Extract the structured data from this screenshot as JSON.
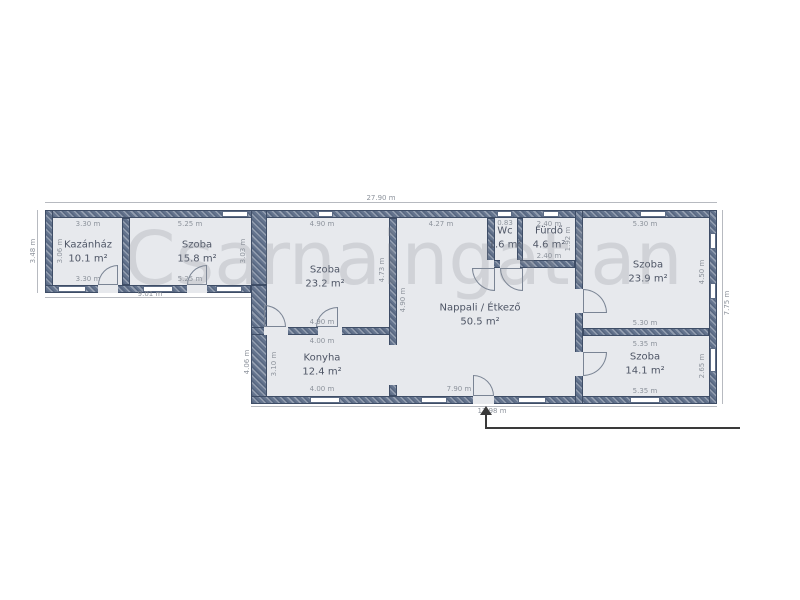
{
  "watermark": {
    "text": "Csarnaingatlan"
  },
  "colors": {
    "wall": "#64748e",
    "wall_border": "#3e4d66",
    "room_fill": "#e7e9ed",
    "dim_text": "#8d939c",
    "label_text": "#4e5565",
    "watermark": "#9a9fa6"
  },
  "plan": {
    "rooms": [
      {
        "name": "Kazánház",
        "area": "10.1 m²",
        "cx": 88,
        "cy": 252
      },
      {
        "name": "Szoba",
        "area": "15.8 m²",
        "cx": 197,
        "cy": 252
      },
      {
        "name": "Szoba",
        "area": "23.2 m²",
        "cx": 325,
        "cy": 277
      },
      {
        "name": "Konyha",
        "area": "12.4 m²",
        "cx": 322,
        "cy": 365
      },
      {
        "name": "Nappali / Étkező",
        "area": "50.5 m²",
        "cx": 480,
        "cy": 315
      },
      {
        "name": "Wc",
        "area": "1.6 m²",
        "cx": 505,
        "cy": 238
      },
      {
        "name": "Fürdő",
        "area": "4.6 m²",
        "cx": 549,
        "cy": 238
      },
      {
        "name": "Szoba",
        "area": "23.9 m²",
        "cx": 648,
        "cy": 272
      },
      {
        "name": "Szoba",
        "area": "14.1 m²",
        "cx": 645,
        "cy": 364
      }
    ],
    "room_fills": [
      {
        "x": 53,
        "y": 218,
        "w": 198,
        "h": 67
      },
      {
        "x": 267,
        "y": 218,
        "w": 442,
        "h": 178
      }
    ],
    "walls": [
      {
        "x": 45,
        "y": 210,
        "w": 672,
        "h": 8
      },
      {
        "x": 45,
        "y": 210,
        "w": 8,
        "h": 83
      },
      {
        "x": 45,
        "y": 285,
        "w": 206,
        "h": 8
      },
      {
        "x": 122,
        "y": 218,
        "w": 8,
        "h": 67
      },
      {
        "x": 251,
        "y": 210,
        "w": 16,
        "h": 75
      },
      {
        "x": 251,
        "y": 285,
        "w": 16,
        "h": 119
      },
      {
        "x": 251,
        "y": 396,
        "w": 466,
        "h": 8
      },
      {
        "x": 709,
        "y": 210,
        "w": 8,
        "h": 194
      },
      {
        "x": 251,
        "y": 327,
        "w": 146,
        "h": 8
      },
      {
        "x": 389,
        "y": 218,
        "w": 8,
        "h": 178
      },
      {
        "x": 575,
        "y": 210,
        "w": 8,
        "h": 194
      },
      {
        "x": 487,
        "y": 218,
        "w": 8,
        "h": 50
      },
      {
        "x": 517,
        "y": 218,
        "w": 6,
        "h": 50
      },
      {
        "x": 487,
        "y": 260,
        "w": 88,
        "h": 8
      },
      {
        "x": 583,
        "y": 328,
        "w": 126,
        "h": 8
      }
    ],
    "openings": [
      {
        "x": 98,
        "y": 285,
        "w": 20,
        "h": 8
      },
      {
        "x": 187,
        "y": 285,
        "w": 20,
        "h": 8
      },
      {
        "x": 264,
        "y": 327,
        "w": 24,
        "h": 8
      },
      {
        "x": 318,
        "y": 327,
        "w": 24,
        "h": 8
      },
      {
        "x": 389,
        "y": 345,
        "w": 8,
        "h": 40
      },
      {
        "x": 474,
        "y": 260,
        "w": 20,
        "h": 8
      },
      {
        "x": 500,
        "y": 260,
        "w": 20,
        "h": 8
      },
      {
        "x": 575,
        "y": 289,
        "w": 8,
        "h": 24
      },
      {
        "x": 575,
        "y": 352,
        "w": 8,
        "h": 24
      },
      {
        "x": 473,
        "y": 396,
        "w": 21,
        "h": 8
      }
    ],
    "windows": [
      {
        "x": 222,
        "y": 211,
        "w": 26,
        "h": 6
      },
      {
        "x": 318,
        "y": 211,
        "w": 15,
        "h": 6
      },
      {
        "x": 497,
        "y": 211,
        "w": 15,
        "h": 6
      },
      {
        "x": 543,
        "y": 211,
        "w": 16,
        "h": 6
      },
      {
        "x": 640,
        "y": 211,
        "w": 26,
        "h": 6
      },
      {
        "x": 58,
        "y": 286,
        "w": 28,
        "h": 6
      },
      {
        "x": 143,
        "y": 286,
        "w": 30,
        "h": 6
      },
      {
        "x": 216,
        "y": 286,
        "w": 26,
        "h": 6
      },
      {
        "x": 310,
        "y": 397,
        "w": 30,
        "h": 6
      },
      {
        "x": 421,
        "y": 397,
        "w": 26,
        "h": 6
      },
      {
        "x": 518,
        "y": 397,
        "w": 28,
        "h": 6
      },
      {
        "x": 630,
        "y": 397,
        "w": 30,
        "h": 6
      },
      {
        "x": 710,
        "y": 233,
        "w": 6,
        "h": 16
      },
      {
        "x": 710,
        "y": 283,
        "w": 6,
        "h": 16
      },
      {
        "x": 710,
        "y": 348,
        "w": 6,
        "h": 24
      }
    ],
    "doors": [
      {
        "x": 98,
        "y": 265,
        "w": 20,
        "h": 20,
        "corner": "tl"
      },
      {
        "x": 187,
        "y": 265,
        "w": 20,
        "h": 20,
        "corner": "tl"
      },
      {
        "x": 264,
        "y": 305,
        "w": 22,
        "h": 22,
        "corner": "tr"
      },
      {
        "x": 316,
        "y": 307,
        "w": 22,
        "h": 20,
        "corner": "tl"
      },
      {
        "x": 472,
        "y": 268,
        "w": 23,
        "h": 23,
        "corner": "bl"
      },
      {
        "x": 500,
        "y": 268,
        "w": 23,
        "h": 23,
        "corner": "bl"
      },
      {
        "x": 583,
        "y": 289,
        "w": 24,
        "h": 24,
        "corner": "tr"
      },
      {
        "x": 583,
        "y": 352,
        "w": 24,
        "h": 24,
        "corner": "br"
      },
      {
        "x": 473,
        "y": 375,
        "w": 21,
        "h": 21,
        "corner": "tr"
      }
    ],
    "dim_lines": [
      {
        "x": 45,
        "y": 202,
        "w": 672,
        "h": 1
      },
      {
        "x": 45,
        "y": 297,
        "w": 206,
        "h": 1
      },
      {
        "x": 251,
        "y": 406,
        "w": 466,
        "h": 1
      },
      {
        "x": 722,
        "y": 210,
        "w": 1,
        "h": 194
      },
      {
        "x": 37,
        "y": 210,
        "w": 1,
        "h": 83
      }
    ],
    "dim_labels": [
      {
        "text": "27.90 m",
        "x": 381,
        "y": 198,
        "v": false
      },
      {
        "text": "3.30 m",
        "x": 88,
        "y": 224,
        "v": false
      },
      {
        "text": "5.25 m",
        "x": 190,
        "y": 224,
        "v": false
      },
      {
        "text": "4.90 m",
        "x": 322,
        "y": 224,
        "v": false
      },
      {
        "text": "4.27 m",
        "x": 441,
        "y": 224,
        "v": false
      },
      {
        "text": "0.83",
        "x": 505,
        "y": 223,
        "v": false
      },
      {
        "text": "2.40 m",
        "x": 549,
        "y": 224,
        "v": false
      },
      {
        "text": "5.30 m",
        "x": 645,
        "y": 224,
        "v": false
      },
      {
        "text": "3.30 m",
        "x": 88,
        "y": 279,
        "v": false
      },
      {
        "text": "5.25 m",
        "x": 190,
        "y": 279,
        "v": false
      },
      {
        "text": "9.01 m",
        "x": 150,
        "y": 294,
        "v": false
      },
      {
        "text": "3.48 m",
        "x": 33,
        "y": 251,
        "v": true
      },
      {
        "text": "3.06 m",
        "x": 60,
        "y": 251,
        "v": true
      },
      {
        "text": "3.03 m",
        "x": 243,
        "y": 251,
        "v": true
      },
      {
        "text": "4.73 m",
        "x": 382,
        "y": 270,
        "v": true
      },
      {
        "text": "4.90 m",
        "x": 403,
        "y": 300,
        "v": true
      },
      {
        "text": "4.90 m",
        "x": 322,
        "y": 322,
        "v": false
      },
      {
        "text": "4.00 m",
        "x": 322,
        "y": 341,
        "v": false
      },
      {
        "text": "4.00 m",
        "x": 322,
        "y": 389,
        "v": false
      },
      {
        "text": "3.10 m",
        "x": 274,
        "y": 364,
        "v": true
      },
      {
        "text": "4.06 m",
        "x": 247,
        "y": 362,
        "v": true
      },
      {
        "text": "1.92 m",
        "x": 568,
        "y": 239,
        "v": true
      },
      {
        "text": "2.40 m",
        "x": 549,
        "y": 256,
        "v": false
      },
      {
        "text": "5.30 m",
        "x": 645,
        "y": 323,
        "v": false
      },
      {
        "text": "4.50 m",
        "x": 702,
        "y": 272,
        "v": true
      },
      {
        "text": "5.35 m",
        "x": 645,
        "y": 344,
        "v": false
      },
      {
        "text": "5.35 m",
        "x": 645,
        "y": 391,
        "v": false
      },
      {
        "text": "2.65 m",
        "x": 702,
        "y": 366,
        "v": true
      },
      {
        "text": "7.75 m",
        "x": 727,
        "y": 303,
        "v": true
      },
      {
        "text": "7.90 m",
        "x": 459,
        "y": 389,
        "v": false
      },
      {
        "text": "13.98 m",
        "x": 492,
        "y": 411,
        "v": false
      }
    ],
    "entry_arrow": {
      "head": {
        "x": 480,
        "y": 406
      },
      "parts": [
        {
          "x": 485,
          "y": 414,
          "w": 2,
          "h": 14
        },
        {
          "x": 485,
          "y": 427,
          "w": 255,
          "h": 2
        }
      ]
    }
  }
}
